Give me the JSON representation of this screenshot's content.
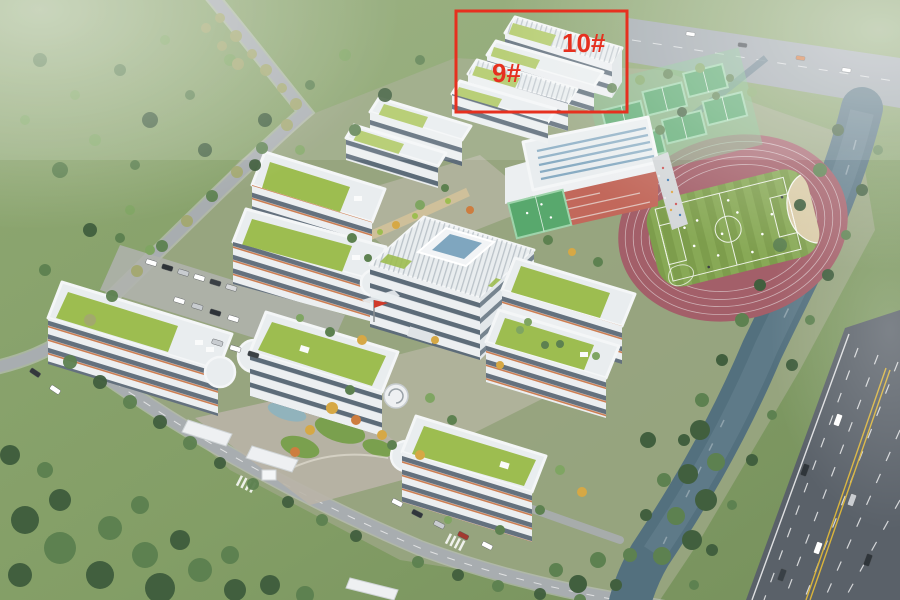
{
  "scene": {
    "type": "aerial-architectural-rendering",
    "subject": "School campus master-plan bird's-eye rendering with two dormitory buildings highlighted by a red box",
    "annotations": {
      "highlight_box_color": "#e6301f",
      "label_9": "9#",
      "label_10": "10#"
    },
    "palette": {
      "meadow_green": "#85a069",
      "campus_ground": "#99a582",
      "roof_green": "#9dbd50",
      "building_white": "#e9edef",
      "window_band": "#5d6c79",
      "accent_orange": "#cd7e52",
      "track_maroon": "#a35f69",
      "pitch_green_a": "#7d9d4c",
      "pitch_green_b": "#88a956",
      "sand_tan": "#d9cba6",
      "court_green": "#58a86d",
      "brick_red": "#c2685b",
      "skylight_blue": "#7fa6bf",
      "river_blue": "#53707e",
      "highway_gray": "#5a6169",
      "road_gray": "#a8adb0",
      "paving": "#b9b4a7",
      "tree_dark": "#415f3e",
      "tree_green": "#5d8150",
      "autumn_yellow": "#d6a845",
      "lane_yellow": "#d9b43c"
    }
  }
}
